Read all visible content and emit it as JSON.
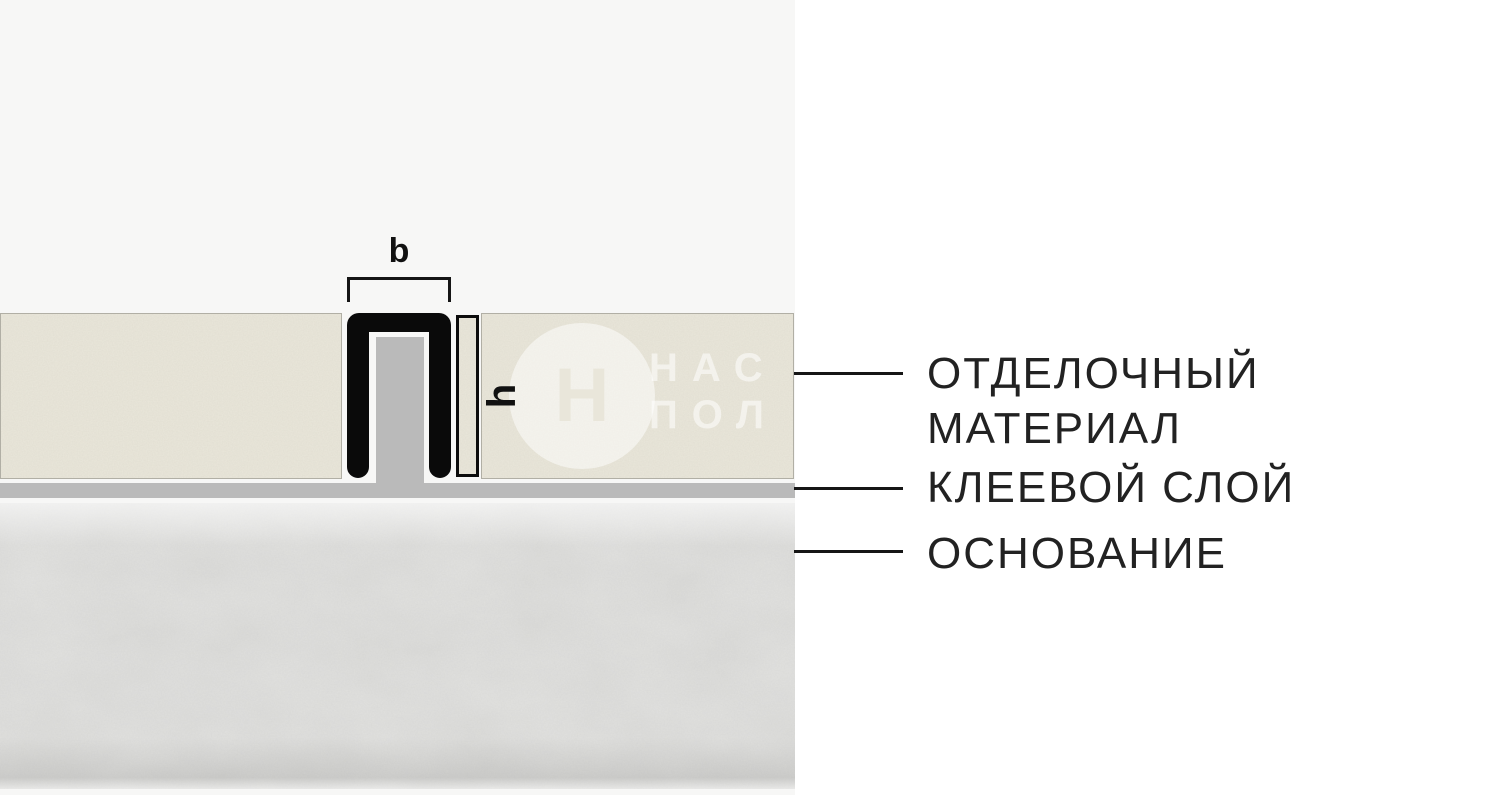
{
  "diagram": {
    "dimensions": {
      "width_label": "b",
      "height_label": "h"
    },
    "watermark": {
      "logo_letter": "Н",
      "text_line1": "НАС",
      "text_line2": "ПОЛ"
    }
  },
  "legend": {
    "items": [
      {
        "name": "finishing-material",
        "lines": [
          "ОТДЕЛОЧНЫЙ",
          "МАТЕРИАЛ"
        ]
      },
      {
        "name": "adhesive-layer",
        "lines": [
          "КЛЕЕВОЙ СЛОЙ"
        ]
      },
      {
        "name": "substrate",
        "lines": [
          "ОСНОВАНИЕ"
        ]
      }
    ]
  },
  "colors": {
    "canvas_left_background": "#f7f7f6",
    "canvas_right_background": "#ffffff",
    "finishing_material": "#eae7db",
    "adhesive_layer": "#bababa",
    "profile_black": "#0a0a0a",
    "substrate": "#e3e3e1",
    "label_text": "#222222",
    "leader_line": "#161616"
  }
}
